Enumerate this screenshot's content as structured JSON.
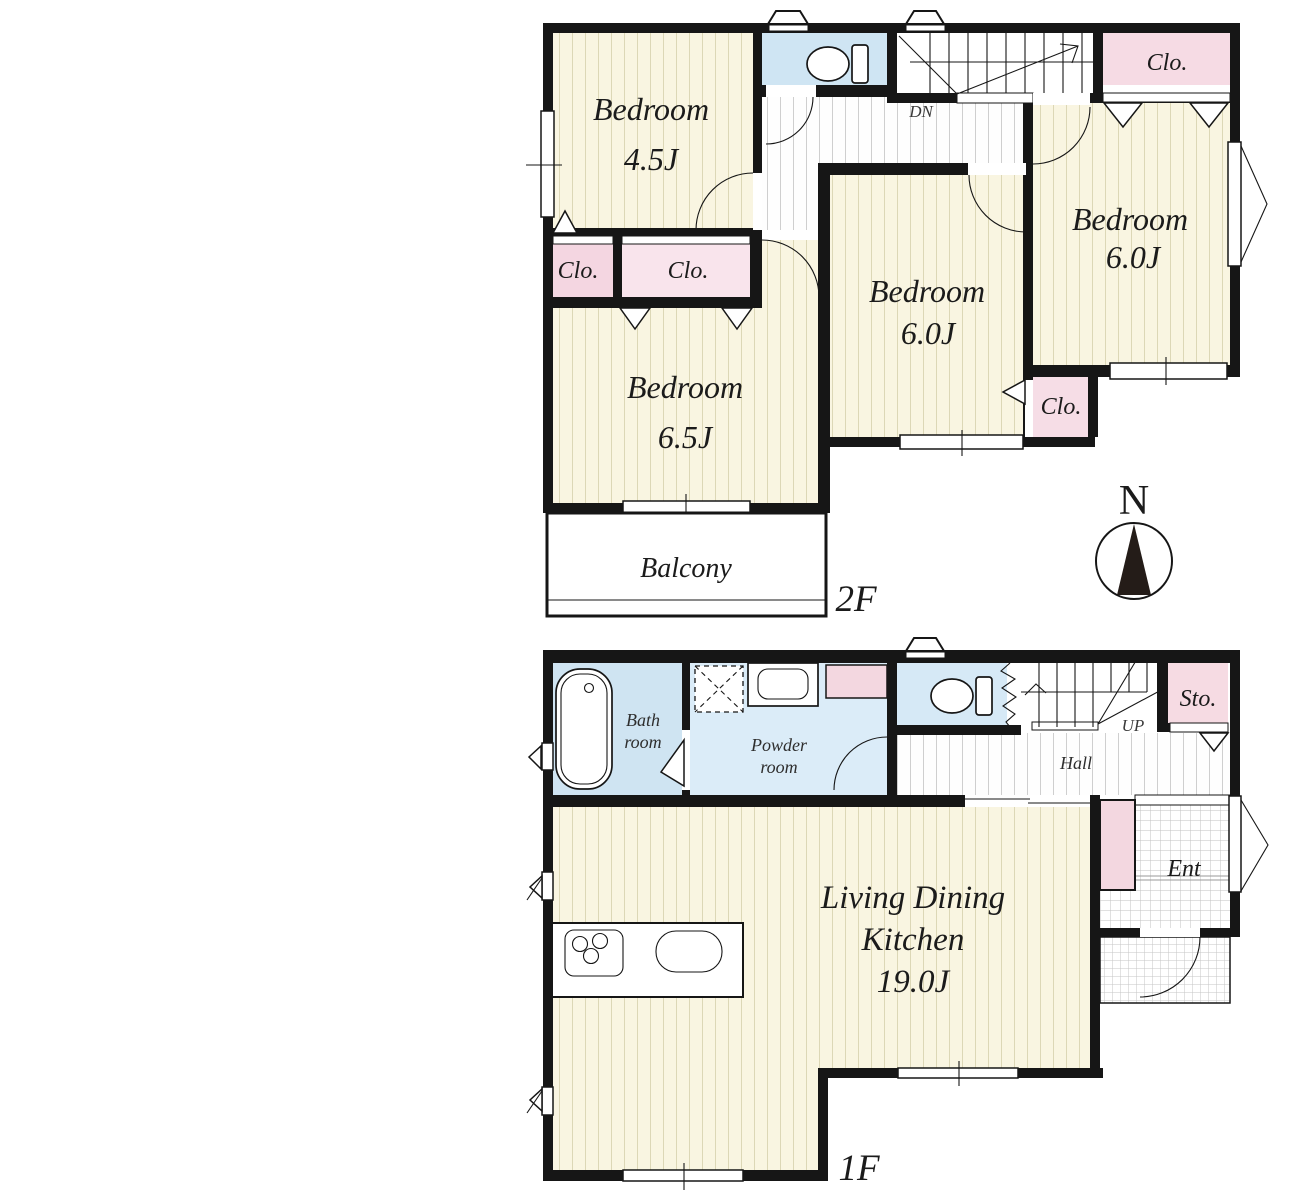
{
  "f2": {
    "floor_label": "2F",
    "compass_north": "N",
    "stairs_label": "DN",
    "bedroom_a": {
      "name": "Bedroom",
      "size": "4.5J"
    },
    "bedroom_b": {
      "name": "Bedroom",
      "size": "6.5J"
    },
    "bedroom_c": {
      "name": "Bedroom",
      "size": "6.0J"
    },
    "bedroom_d": {
      "name": "Bedroom",
      "size": "6.0J"
    },
    "closet_a": "Clo.",
    "closet_b": "Clo.",
    "closet_c": "Clo.",
    "closet_d": "Clo.",
    "balcony": "Balcony"
  },
  "f1": {
    "floor_label": "1F",
    "stairs_label": "UP",
    "hall": "Hall",
    "storage": "Sto.",
    "entrance": "Ent",
    "bath": {
      "line1": "Bath",
      "line2": "room"
    },
    "powder": {
      "line1": "Powder",
      "line2": "room"
    },
    "ldk": {
      "line1": "Living Dining",
      "line2": "Kitchen",
      "size": "19.0J"
    }
  },
  "colors": {
    "wall": "#161616",
    "room_yellow": "#f9f5e1",
    "closet_pink": "#f6dbe4",
    "water_blue": "#d5e8f5",
    "tile_line": "#c2c2c2"
  }
}
